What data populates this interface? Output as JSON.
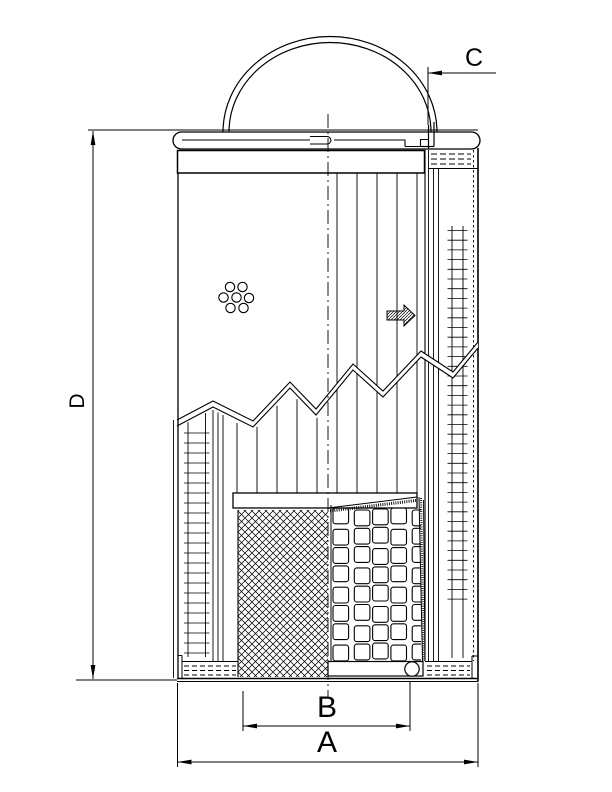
{
  "document": {
    "type": "technical-drawing",
    "subject": "filter-element-cross-section"
  },
  "colors": {
    "line": "#000000",
    "background": "#ffffff"
  },
  "dimensions": {
    "A": {
      "label": "A"
    },
    "B": {
      "label": "B"
    },
    "C": {
      "label": "C"
    },
    "D": {
      "label": "D"
    }
  },
  "symbols": {
    "flow_arrow": "flow-direction-arrow",
    "handle": "bail-handle",
    "perforations": "perforation-holes"
  }
}
